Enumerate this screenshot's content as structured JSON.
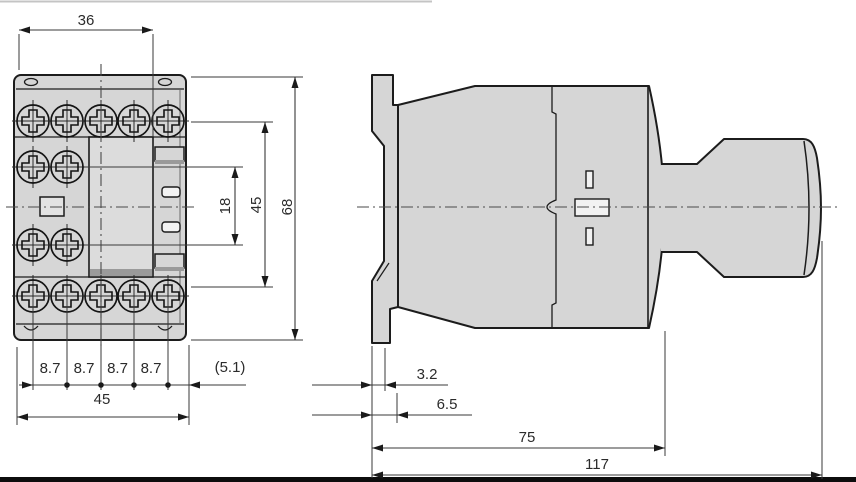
{
  "drawing_title": "contactor-dimension-drawing",
  "front_view": {
    "dim_width_top": "36",
    "dim_pitch": [
      "8.7",
      "8.7",
      "8.7",
      "8.7"
    ],
    "dim_margin_right": "(5.1)",
    "dim_width_bottom": "45",
    "dim_height_contact": "18",
    "dim_height_mount": "45",
    "dim_height_total": "68"
  },
  "side_view": {
    "dim_clip_depth": "3.2",
    "dim_flange_depth": "6.5",
    "dim_body_depth": "75",
    "dim_total_depth": "117"
  },
  "colors": {
    "body_fill": "#d6d6d6",
    "outline": "#1c1c1c",
    "dimension_lines": "#3a3a3a",
    "shadow": "#9a9a9a",
    "bottom_border": "#0d0d0d",
    "top_border": "#c4c4c4"
  }
}
